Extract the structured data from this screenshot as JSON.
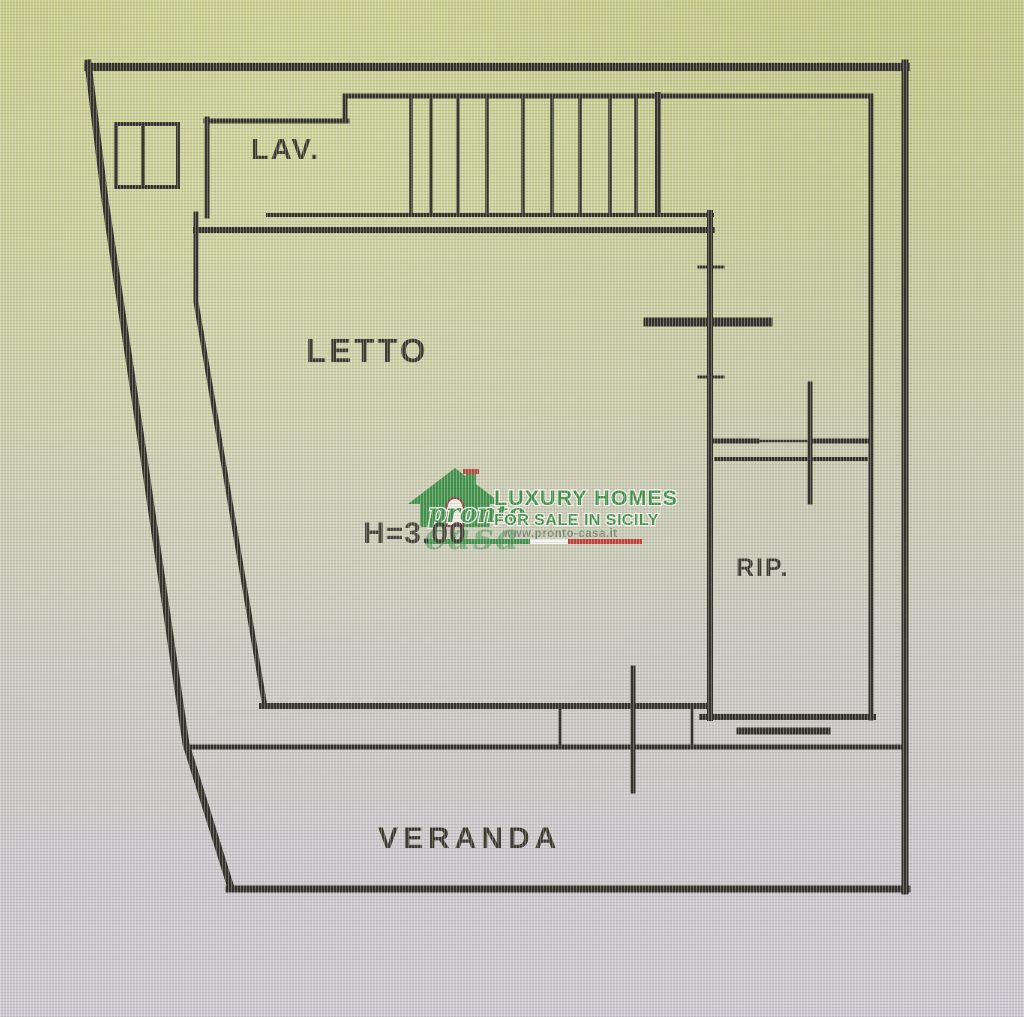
{
  "floorplan": {
    "rooms": [
      {
        "id": "lav",
        "label": "LAV."
      },
      {
        "id": "letto",
        "label": "LETTO"
      },
      {
        "id": "rip",
        "label": "RIP."
      },
      {
        "id": "veranda",
        "label": "VERANDA"
      }
    ],
    "height_annotation": "H=3.00",
    "line_color": "#32312a"
  },
  "watermark": {
    "brand": "pronto",
    "brand_suffix": "casa",
    "line1": "LUXURY HOMES",
    "line2": "FOR SALE IN SICILY",
    "website": "www.pronto-casa.it",
    "colors": {
      "green": "#3c8f47",
      "red": "#c23b35",
      "white": "#ffffff"
    }
  },
  "photo": {
    "background_top": "#c2c783",
    "background_bottom": "#cec9d2"
  }
}
